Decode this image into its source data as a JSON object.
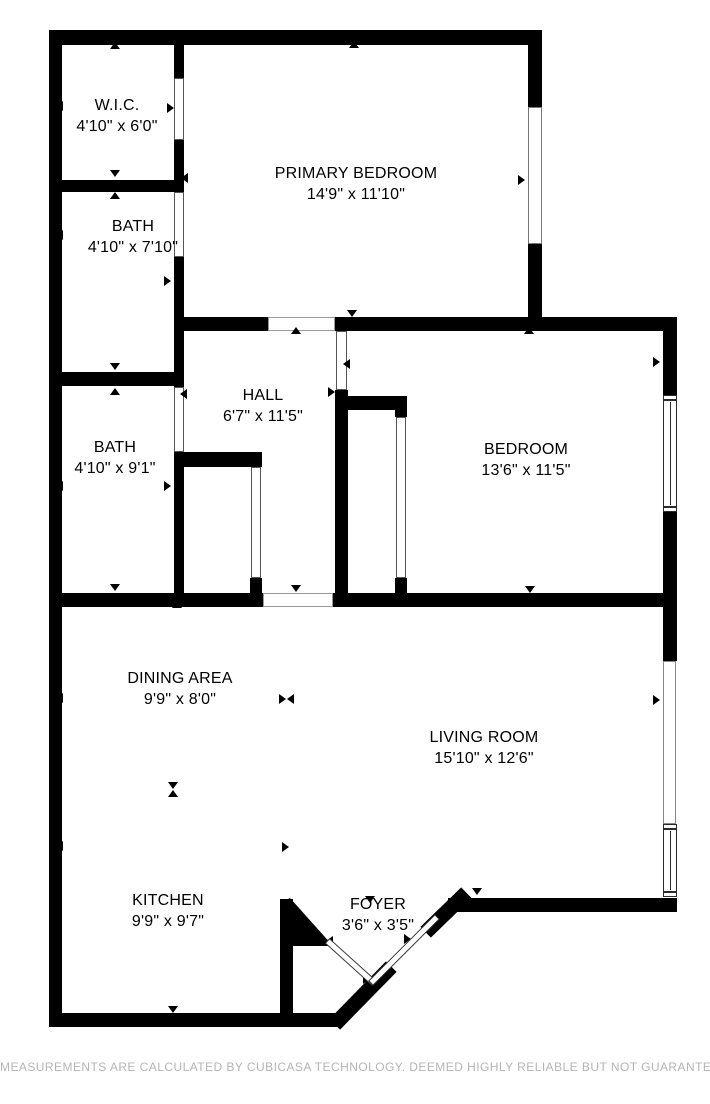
{
  "rooms": {
    "wic": {
      "name": "W.I.C.",
      "dims": "4'10\" x 6'0\""
    },
    "primary": {
      "name": "PRIMARY BEDROOM",
      "dims": "14'9\" x 11'10\""
    },
    "bath1": {
      "name": "BATH",
      "dims": "4'10\" x 7'10\""
    },
    "bath2": {
      "name": "BATH",
      "dims": "4'10\" x 9'1\""
    },
    "hall": {
      "name": "HALL",
      "dims": "6'7\" x 11'5\""
    },
    "bedroom": {
      "name": "BEDROOM",
      "dims": "13'6\" x 11'5\""
    },
    "dining": {
      "name": "DINING AREA",
      "dims": "9'9\" x 8'0\""
    },
    "living": {
      "name": "LIVING ROOM",
      "dims": "15'10\" x 12'6\""
    },
    "kitchen": {
      "name": "KITCHEN",
      "dims": "9'9\" x 9'7\""
    },
    "foyer": {
      "name": "FOYER",
      "dims": "3'6\" x 3'5\""
    }
  },
  "footer": "MEASUREMENTS ARE CALCULATED BY CUBICASA TECHNOLOGY. DEEMED HIGHLY RELIABLE BUT NOT GUARANTEED.",
  "colors": {
    "wall": "#000000",
    "background": "#ffffff",
    "footer_text": "#b5b5b5"
  }
}
